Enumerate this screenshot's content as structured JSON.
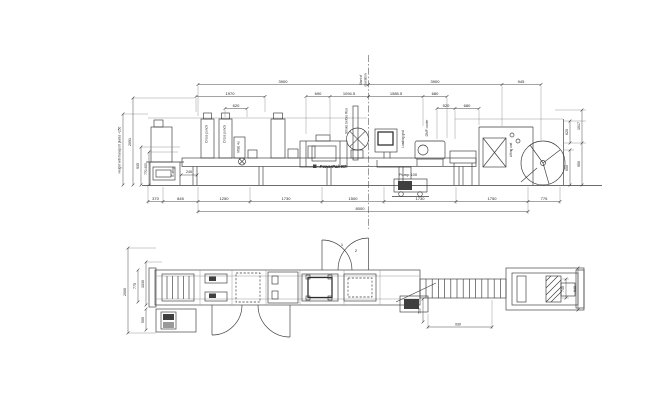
{
  "drawing": {
    "background": "#ffffff",
    "ink": "#3a3a3a",
    "icons": {
      "brand_logo": "filled-square"
    }
  },
  "top_view": {
    "dims_top_row1": [
      "3900",
      "3900",
      "945"
    ],
    "dims_top_row2": [
      "1970",
      "690",
      "1094.5",
      "1585.5",
      "680"
    ],
    "dims_top_row3": [
      "620",
      "520",
      "680"
    ],
    "dims_bottom_chain": [
      "370",
      "845",
      "1250",
      "1730",
      "1500",
      "1730",
      "1750",
      "775"
    ],
    "dims_bottom_total": "8000",
    "dims_left": {
      "note": "Height with transport plates +250",
      "overall_height": "2091",
      "work_height": "935",
      "adjust_range": "770-905",
      "infeed": "245"
    },
    "dims_right": {
      "top_inner": "620",
      "top_outer": "1017",
      "bottom_inner": "650",
      "bottom_outer": "950"
    },
    "labels": {
      "estop": "E-stop",
      "cross_punch_1": "Cross punch",
      "cross_punch_2": "Cross punch",
      "lift_unit": "MSE 4u",
      "brand": "PowerPak RT",
      "stroke_note": "Stroke before Run",
      "centerline_1": "Start of",
      "centerline_2": "operation",
      "loading_grid": "Loading grid",
      "cooler": "GMF cooler",
      "pump": "Pump 100",
      "film_unit": "Lifting unit"
    }
  },
  "plan_view": {
    "dims_left": [
      "2000",
      "775",
      "1030",
      "505"
    ],
    "dims_right": [
      "740",
      "940"
    ],
    "dims_bottom": [
      "500",
      "930"
    ],
    "door_numbers": [
      "1",
      "2"
    ]
  }
}
